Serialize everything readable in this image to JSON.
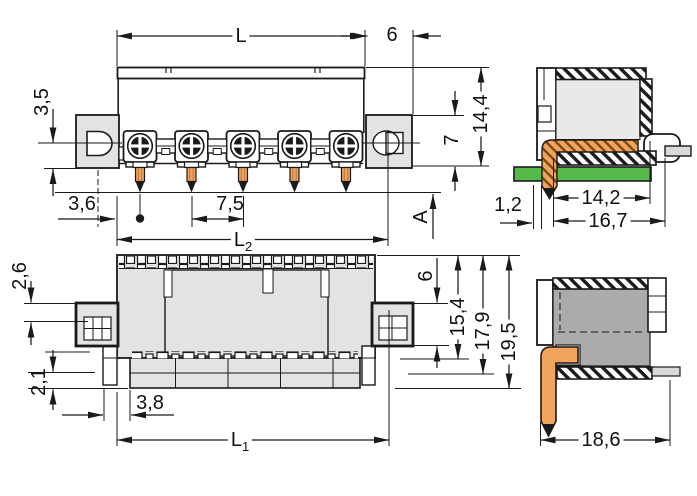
{
  "drawing": {
    "colors": {
      "line": "#1a1a1a",
      "body_fill": "#e3e3e3",
      "interior_fill": "#ababab",
      "pin_orange": "#f2a35c",
      "pcb_green": "#56b94c",
      "background": "#ffffff"
    },
    "dims": {
      "l": "L",
      "six_top": "6",
      "three_five": "3,5",
      "fourteen_four": "14,4",
      "seven": "7",
      "a": "A",
      "three_six": "3,6",
      "seven_five": "7,5",
      "l2": {
        "main": "L",
        "sub": "2"
      },
      "one_two": "1,2",
      "fourteen_two": "14,2",
      "sixteen_seven": "16,7",
      "two_six": "2,6",
      "two_one": "2,1",
      "three_eight": "3,8",
      "l1": {
        "main": "L",
        "sub": "1"
      },
      "six_bottom": "6",
      "fifteen_four": "15,4",
      "seventeen_nine": "17,9",
      "nineteen_five": "19,5",
      "eighteen_six": "18,6"
    }
  }
}
